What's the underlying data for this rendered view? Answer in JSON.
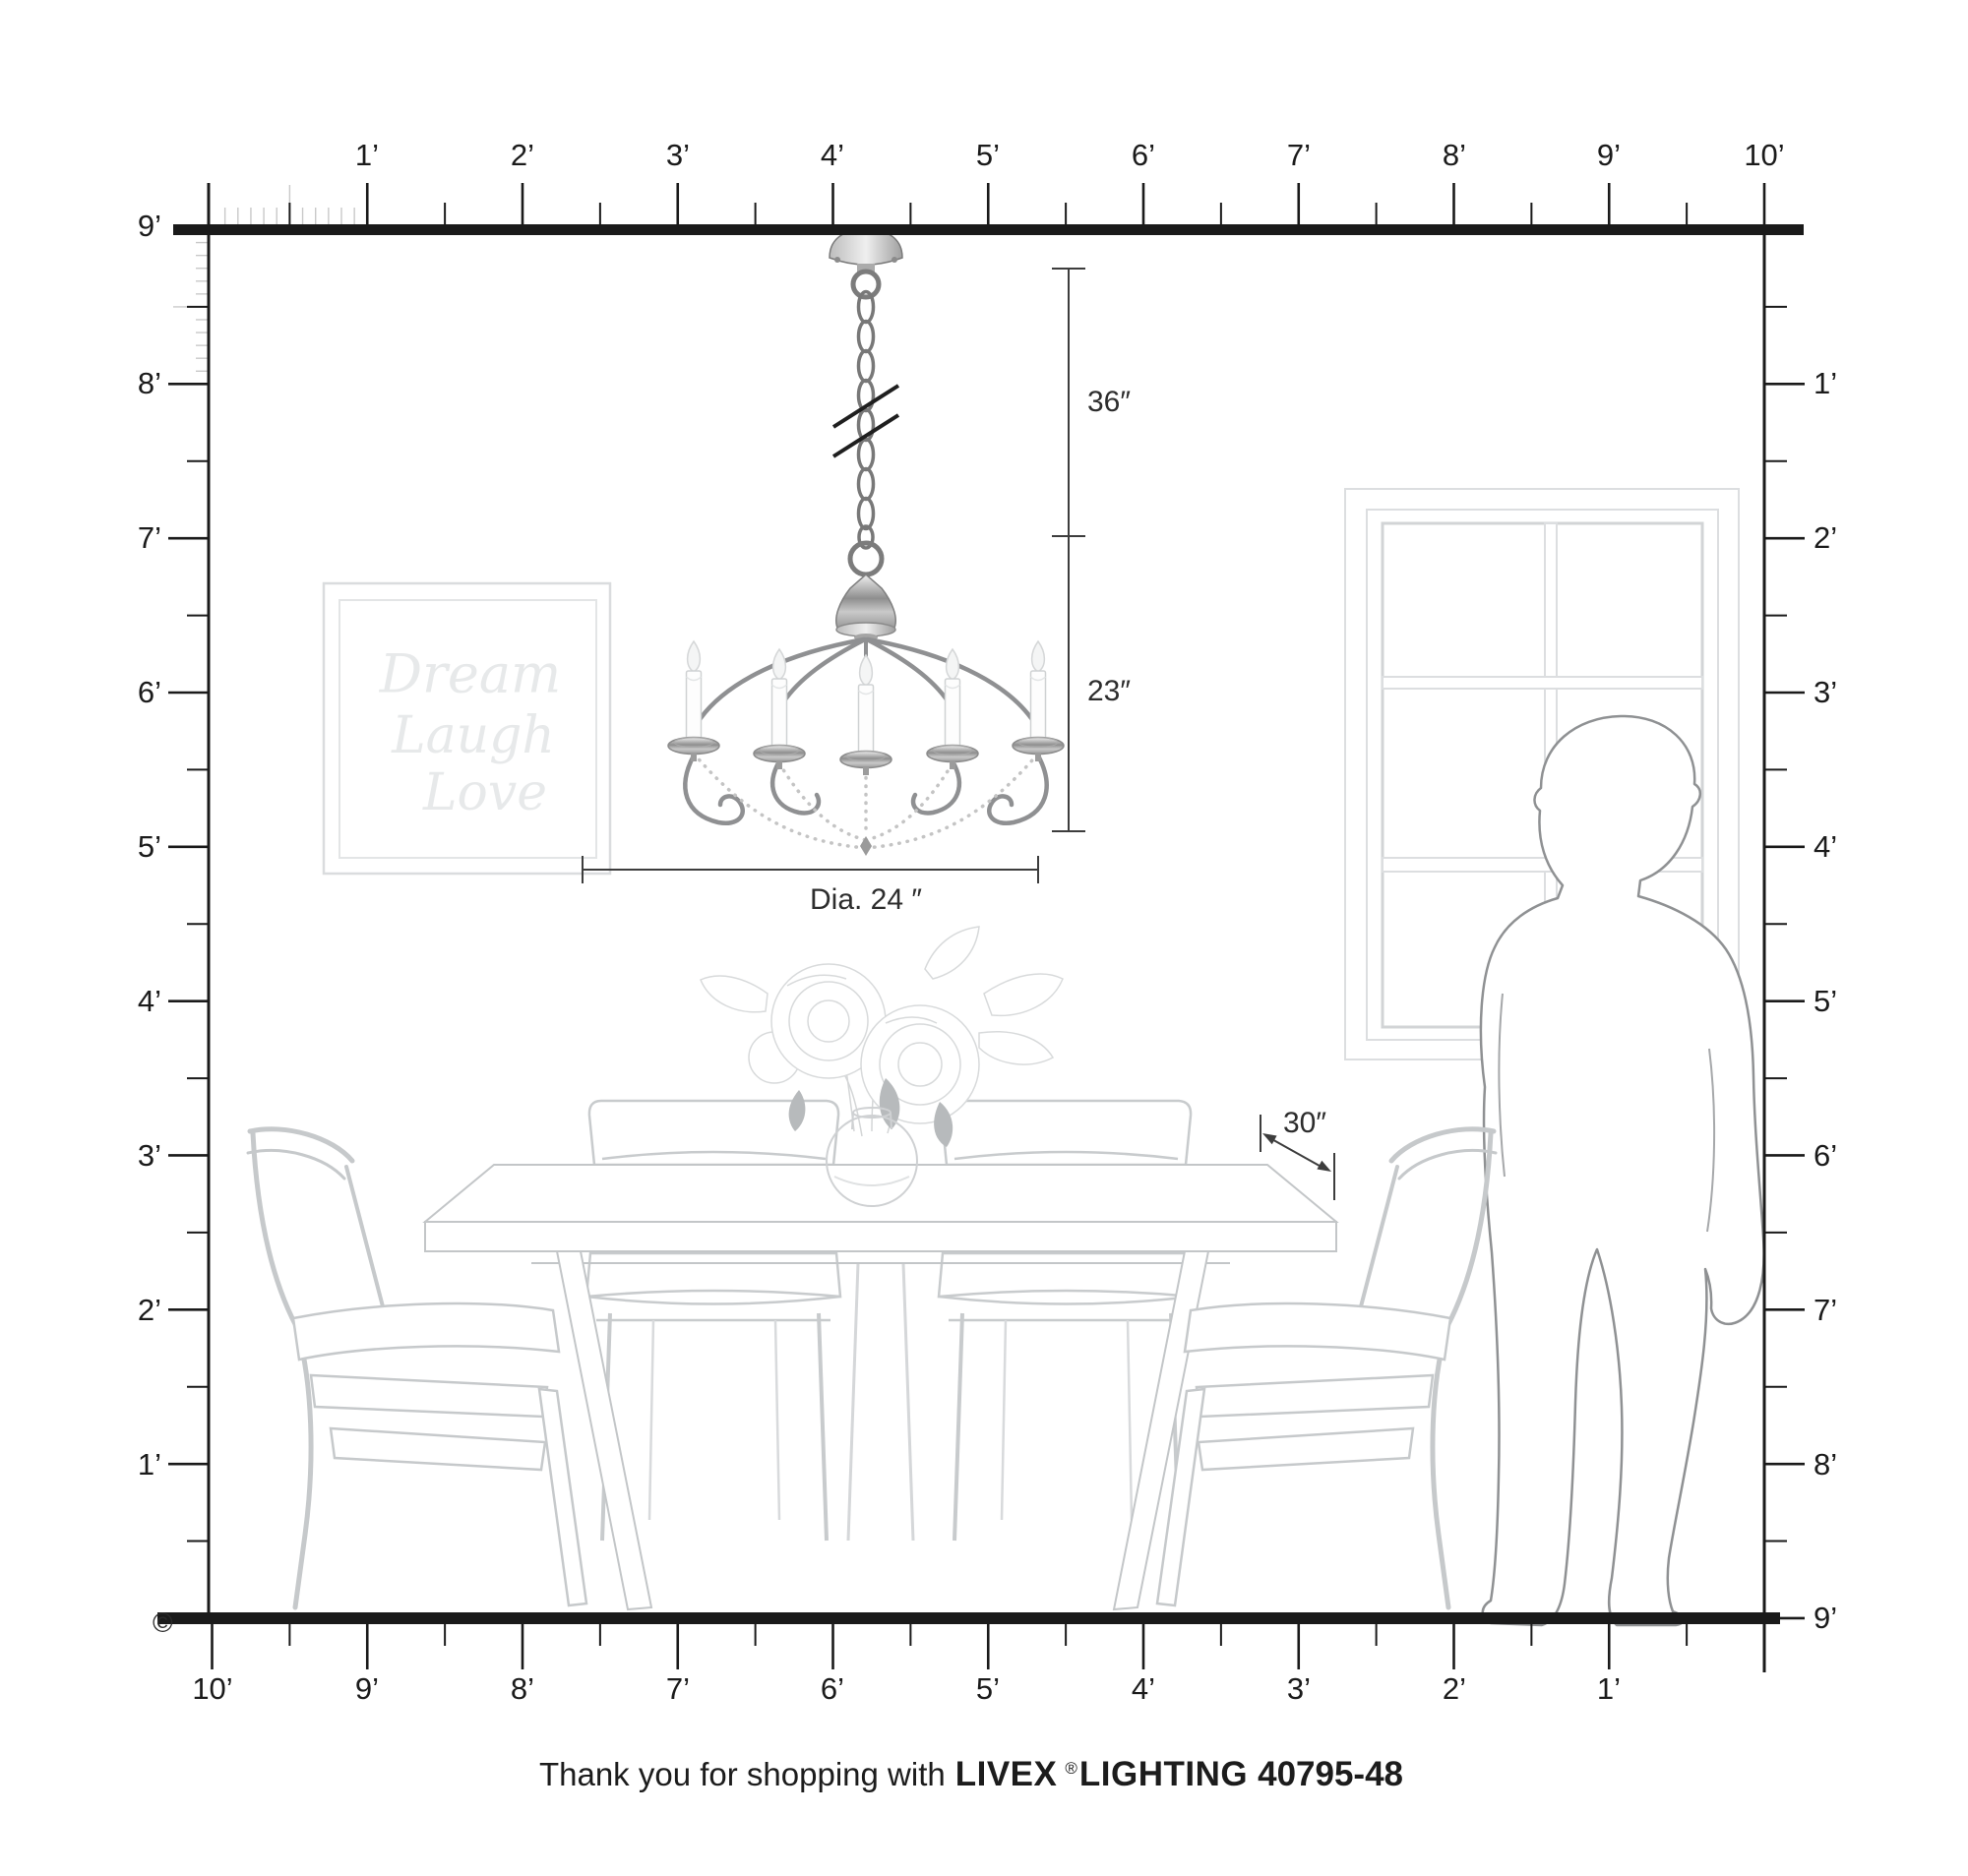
{
  "rulers": {
    "top_labels": [
      "1’",
      "2’",
      "3’",
      "4’",
      "5’",
      "6’",
      "7’",
      "8’",
      "9’",
      "10’"
    ],
    "bottom_labels": [
      "10’",
      "9’",
      "8’",
      "7’",
      "6’",
      "5’",
      "4’",
      "3’",
      "2’",
      "1’"
    ],
    "left_labels": [
      "9’",
      "8’",
      "7’",
      "6’",
      "5’",
      "4’",
      "3’",
      "2’",
      "1’"
    ],
    "right_labels": [
      "1’",
      "2’",
      "3’",
      "4’",
      "5’",
      "6’",
      "7’",
      "8’",
      "9’"
    ]
  },
  "dimension_labels": {
    "chain_length": "36″",
    "fixture_height": "23″",
    "fixture_diameter": "Dia. 24 ″",
    "table_depth": "30″"
  },
  "wall_art": {
    "line1": "Dream",
    "line2": "Laugh",
    "line3": "Love"
  },
  "footer": {
    "prefix": "Thank you for shopping with",
    "brand": "LIVEX",
    "registered_mark": "®",
    "product_line": "LIGHTING",
    "model": "40795-48"
  },
  "copyright_symbol": "©",
  "colors": {
    "ruler": "#1a1a1a",
    "ruler_minor": "#c9c9c9",
    "dimension": "#3d3d3d",
    "furniture_line": "#c6c9cb",
    "window_line": "#dcdee0",
    "silhouette_line": "#8f9193",
    "wall_art_text": "#e7e9ea",
    "metal_dark": "#7a7a7a"
  }
}
